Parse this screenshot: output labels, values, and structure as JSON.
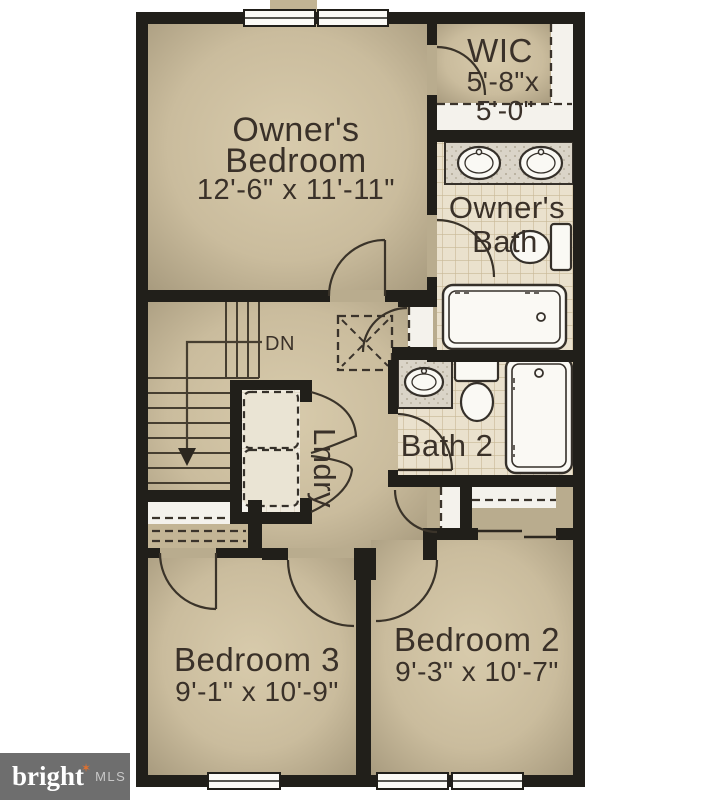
{
  "rooms": {
    "owners_bedroom": {
      "line1": "Owner's",
      "line2": "Bedroom",
      "dims": "12'-6\" x 11'-11\""
    },
    "wic": {
      "name": "WIC",
      "dims_line1": "5'-8\"x",
      "dims_line2": "5'-0\""
    },
    "owners_bath": {
      "line1": "Owner's",
      "line2": "Bath"
    },
    "bath_2": {
      "name": "Bath 2"
    },
    "laundry": {
      "name": "Lndry"
    },
    "bedroom_3": {
      "name": "Bedroom 3",
      "dims": "9'-1\" x 10'-9\""
    },
    "bedroom_2": {
      "name": "Bedroom 2",
      "dims": "9'-3\" x 10'-7\""
    }
  },
  "stairs": {
    "down_label": "DN"
  },
  "watermark": {
    "brand": "bright",
    "org": "MLS"
  },
  "colors": {
    "wall": "#211f1a",
    "floor_tan": "#cbbd9e",
    "floor_tan_dark": "#a3977a",
    "bath_tile": "#eae1cd",
    "label_text": "#3a3129",
    "logo_bg": "#6e6e6e",
    "logo_text": "#ffffff",
    "logo_mls": "#c8c8c8",
    "logo_star": "#e2702d"
  }
}
